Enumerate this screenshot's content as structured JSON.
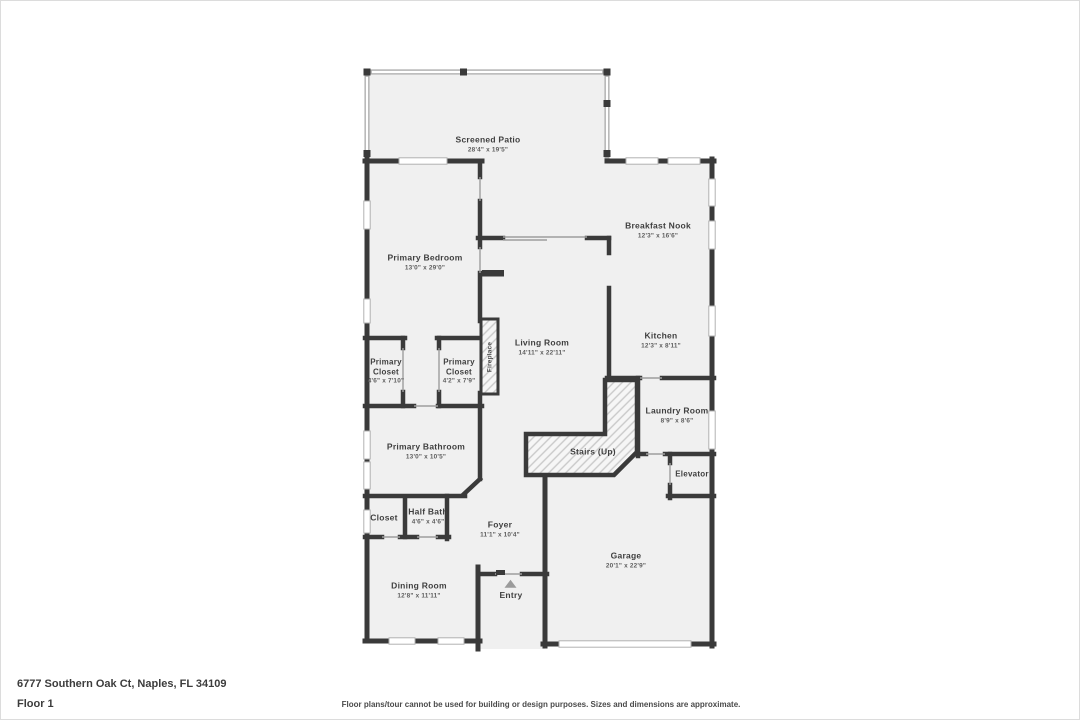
{
  "page": {
    "address": "6777 Southern Oak Ct, Naples, FL 34109",
    "floor_label": "Floor 1",
    "disclaimer": "Floor plans/tour cannot be used for building or design purposes. Sizes and dimensions are approximate."
  },
  "colors": {
    "wall": "#3a3a3a",
    "floor_fill": "#f0f0f0",
    "screen_wall": "#a8a8a8",
    "window": "#ffffff",
    "hatch_line": "#c9c9c9",
    "entry_arrow": "#9b9b9b",
    "label_text": "#3f3f3f"
  },
  "rooms": [
    {
      "name": "Screened Patio",
      "dims": "28'4\" x 19'5\""
    },
    {
      "name": "Breakfast Nook",
      "dims": "12'3\" x 16'6\""
    },
    {
      "name": "Primary Bedroom",
      "dims": "13'0\" x 29'0\""
    },
    {
      "name": "Living Room",
      "dims": "14'11\" x 22'11\""
    },
    {
      "name": "Kitchen",
      "dims": "12'3\" x 8'11\""
    },
    {
      "name": "Fireplace",
      "dims": ""
    },
    {
      "name": "Primary Closet",
      "dims": "4'6\" x 7'10\""
    },
    {
      "name": "Primary Closet",
      "dims": "4'2\" x 7'9\""
    },
    {
      "name": "Laundry Room",
      "dims": "8'9\" x 8'6\""
    },
    {
      "name": "Primary Bathroom",
      "dims": "13'0\" x 10'5\""
    },
    {
      "name": "Stairs (Up)",
      "dims": ""
    },
    {
      "name": "Elevator",
      "dims": ""
    },
    {
      "name": "Closet",
      "dims": ""
    },
    {
      "name": "Half Bath",
      "dims": "4'6\" x 4'6\""
    },
    {
      "name": "Foyer",
      "dims": "11'1\" x 10'4\""
    },
    {
      "name": "Garage",
      "dims": "20'1\" x 22'9\""
    },
    {
      "name": "Dining Room",
      "dims": "12'8\" x 11'11\""
    },
    {
      "name": "Entry",
      "dims": ""
    }
  ]
}
